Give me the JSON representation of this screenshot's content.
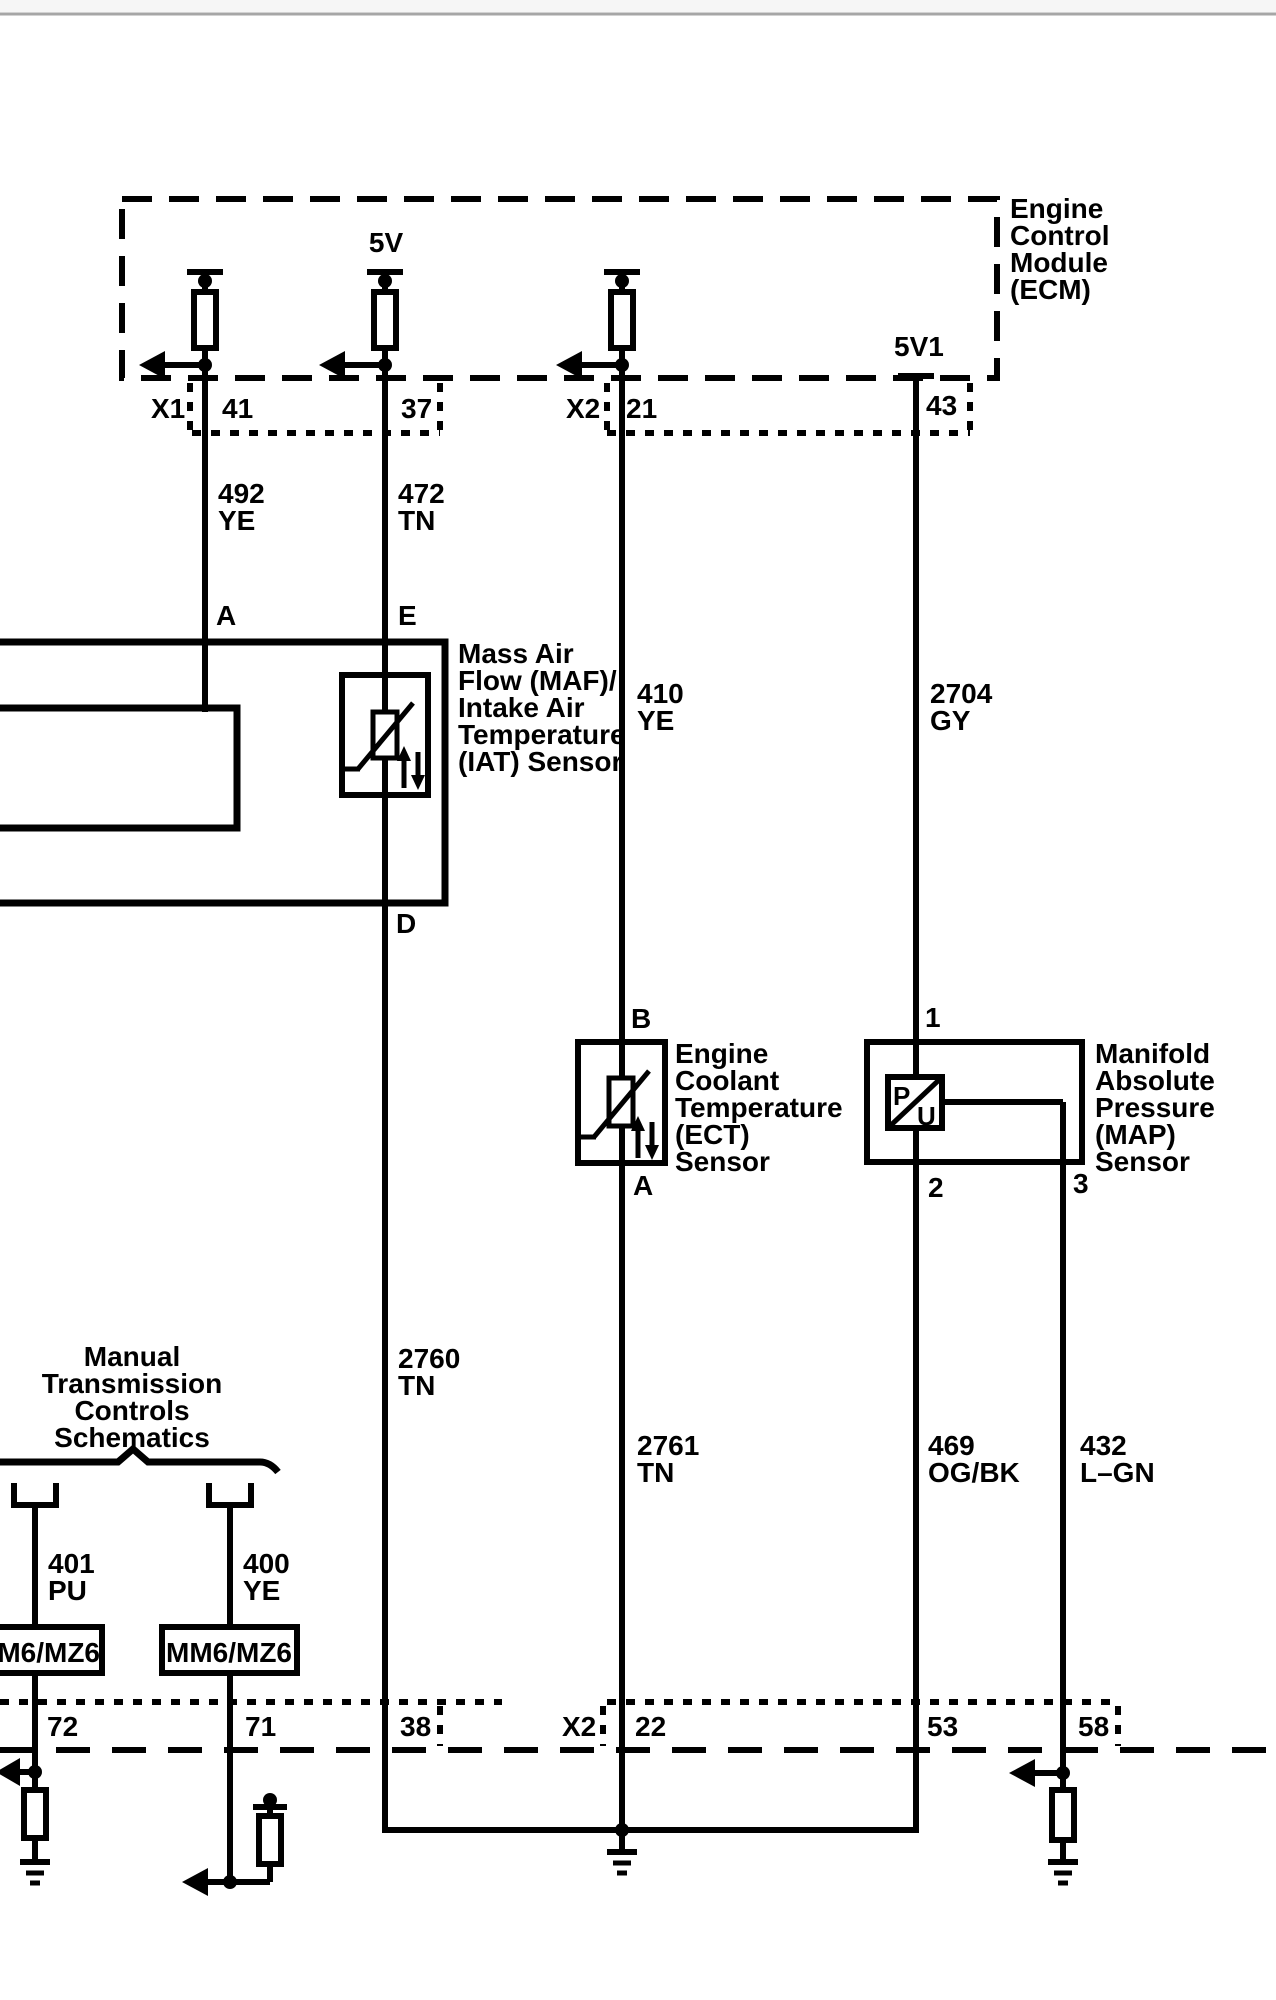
{
  "page": {
    "background": "#ffffff",
    "line_color": "#000000",
    "top_rule_color": "#a6a6a6"
  },
  "ecm": {
    "title_lines": [
      "Engine",
      "Control",
      "Module",
      "(ECM)"
    ],
    "v5_label": "5V",
    "v5v1_label": "5V1"
  },
  "top_connector": {
    "x1": "X1",
    "x2": "X2",
    "pin_41": "41",
    "pin_37": "37",
    "pin_21": "21",
    "pin_43": "43"
  },
  "wires": {
    "w492": [
      "492",
      "YE"
    ],
    "w472": [
      "472",
      "TN"
    ],
    "w410": [
      "410",
      "YE"
    ],
    "w2704": [
      "2704",
      "GY"
    ],
    "w2760": [
      "2760",
      "TN"
    ],
    "w2761": [
      "2761",
      "TN"
    ],
    "w469": [
      "469",
      "OG/BK"
    ],
    "w432": [
      "432",
      "L–GN"
    ],
    "w401": [
      "401",
      "PU"
    ],
    "w400": [
      "400",
      "YE"
    ]
  },
  "maf": {
    "label_lines": [
      "Mass Air",
      "Flow (MAF)/",
      "Intake Air",
      "Temperature",
      "(IAT) Sensor"
    ],
    "pin_a": "A",
    "pin_e": "E",
    "pin_d": "D"
  },
  "ect": {
    "label_lines": [
      "Engine",
      "Coolant",
      "Temperature",
      "(ECT)",
      "Sensor"
    ],
    "pin_b": "B",
    "pin_a": "A"
  },
  "map": {
    "label_lines": [
      "Manifold",
      "Absolute",
      "Pressure",
      "(MAP)",
      "Sensor"
    ],
    "pin_1": "1",
    "pin_2": "2",
    "pin_3": "3",
    "p": "P",
    "u": "U"
  },
  "manual_trans": {
    "label_lines": [
      "Manual",
      "Transmission",
      "Controls",
      "Schematics"
    ],
    "connector_1": "MM6/MZ6",
    "connector_2": "MM6/MZ6"
  },
  "bottom_connector": {
    "x2": "X2",
    "pin_72": "72",
    "pin_71": "71",
    "pin_38": "38",
    "pin_22": "22",
    "pin_53": "53",
    "pin_58": "58"
  }
}
